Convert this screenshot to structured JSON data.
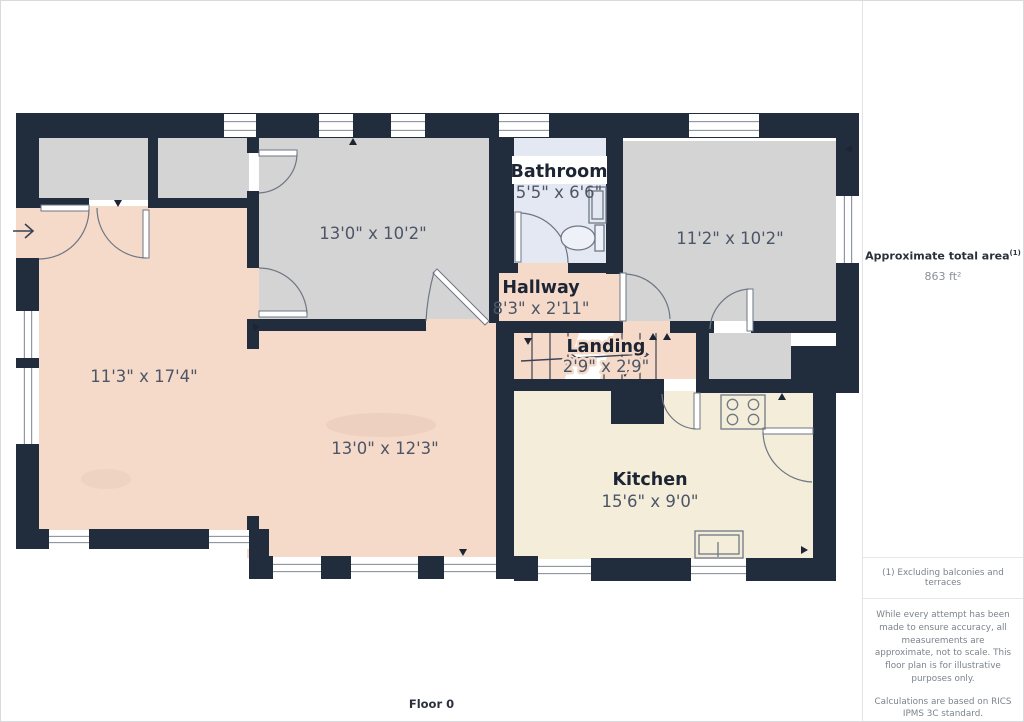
{
  "plan": {
    "floor_label": "Floor 0",
    "rooms": {
      "bathroom": {
        "name": "Bathroom",
        "dims": "5'5\" x 6'6\""
      },
      "hallway": {
        "name": "Hallway",
        "dims": "8'3\" x 2'11\""
      },
      "landing": {
        "name": "Landing",
        "dims": "2'9\" x 2'9\""
      },
      "kitchen": {
        "name": "Kitchen",
        "dims": "15'6\" x 9'0\""
      },
      "front_room": {
        "dims": "13'0\" x 10'2\""
      },
      "right_room": {
        "dims": "11'2\" x 10'2\""
      },
      "living_room": {
        "dims": "11'3\" x 17'4\""
      },
      "dining_room": {
        "dims": "13'0\" x 12'3\""
      }
    }
  },
  "sidebar": {
    "area_label": "Approximate total area",
    "area_footnote_marker": "(1)",
    "area_value": "863 ft²",
    "footnote": "(1) Excluding balconies and terraces",
    "disclaimer_accuracy": "While every attempt has been made to ensure accuracy, all measurements are approximate, not to scale. This floor plan is for illustrative purposes only.",
    "disclaimer_standard": "Calculations are based on RICS IPMS 3C standard.",
    "brand": {
      "name": "GIRAFFE",
      "suffix": "360"
    }
  },
  "colors": {
    "wall": "#212d3d",
    "room_gray": "#d4d4d5",
    "room_pink": "#f5dac9",
    "room_cream": "#f3edd9",
    "room_bathroom": "#e4e8f2",
    "dim_text": "#4d5667",
    "name_text": "#1d2534"
  }
}
